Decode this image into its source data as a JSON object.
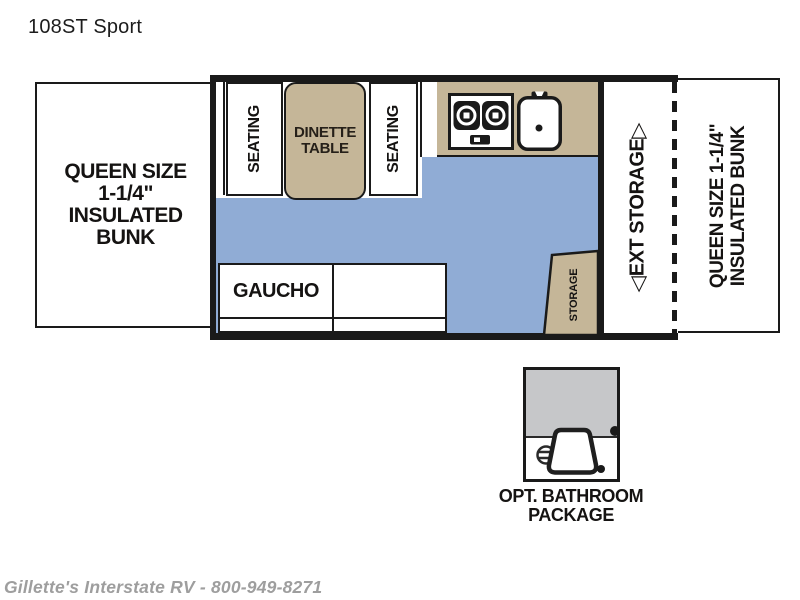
{
  "title": "108ST Sport",
  "floorplan": {
    "left_bunk": {
      "lines": [
        "QUEEN SIZE",
        "1-1/4\"",
        "INSULATED",
        "BUNK"
      ]
    },
    "seating_left": "SEATING",
    "seating_right": "SEATING",
    "dinette": {
      "lines": [
        "DINETTE",
        "TABLE"
      ]
    },
    "gaucho": "GAUCHO",
    "storage": "STORAGE",
    "ext_storage": {
      "label": "EXT STORAGE",
      "arrow_down": "◁",
      "arrow_up": "▷"
    },
    "right_bunk": {
      "lines": [
        "QUEEN SIZE 1-1/4\"",
        "INSULATED BUNK"
      ]
    }
  },
  "bathroom": {
    "caption_lines": [
      "OPT. BATHROOM",
      "PACKAGE"
    ]
  },
  "watermark": "Gillette's Interstate RV - 800-949-8271",
  "colors": {
    "tan": "#c5b698",
    "floor_blue": "#90acd5",
    "shower_gray": "#c6c7c9",
    "wall_black": "#1a1a1a",
    "watermark_gray": "#9e9e9e"
  }
}
